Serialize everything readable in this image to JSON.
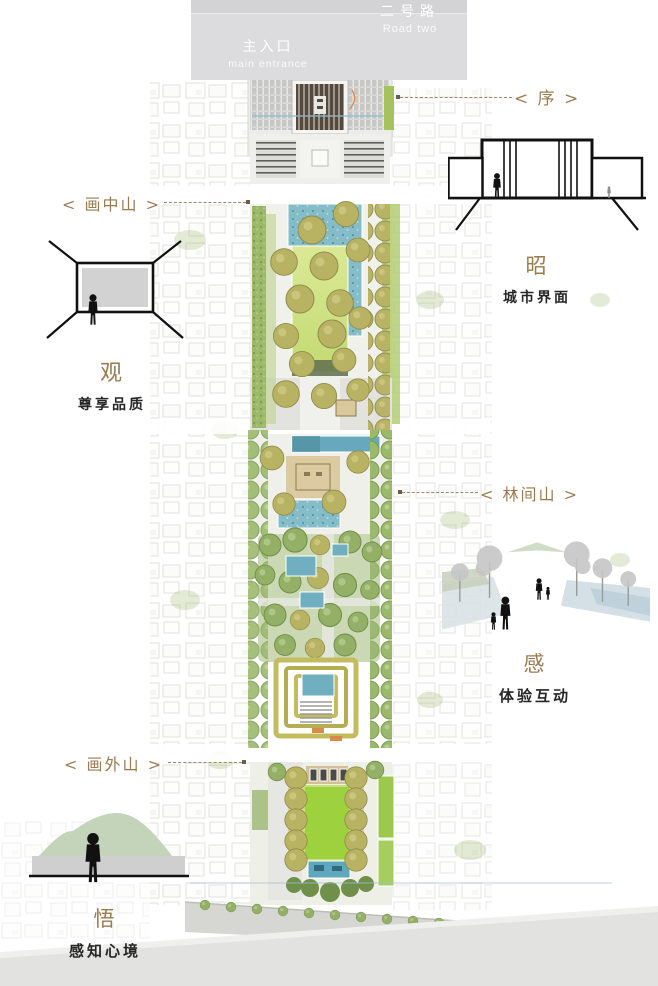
{
  "colors": {
    "accent_gold": "#9a7b50",
    "water_teal": "#84bcc8",
    "lawn_green": "#c3da72",
    "bright_lawn": "#9ed13e",
    "tree_olive": "#b8b263",
    "road_gray": "#dcdcde"
  },
  "top_road": {
    "name_cn": "二号路",
    "name_en": "Road two"
  },
  "entrance": {
    "name_cn": "主入口",
    "name_en": "main entrance"
  },
  "callouts": {
    "xu": "< 序 >",
    "hua_zhong_shan": "< 画中山 >",
    "lin_jian_shan": "< 林间山 >",
    "hua_wai_shan": "< 画外山 >"
  },
  "legend_sections": {
    "zhao": {
      "title": "昭",
      "subtitle": "城市界面"
    },
    "guan": {
      "title": "观",
      "subtitle": "尊享品质"
    },
    "gan": {
      "title": "感",
      "subtitle": "体验互动"
    },
    "wu": {
      "title": "悟",
      "subtitle": "感知心境"
    }
  }
}
